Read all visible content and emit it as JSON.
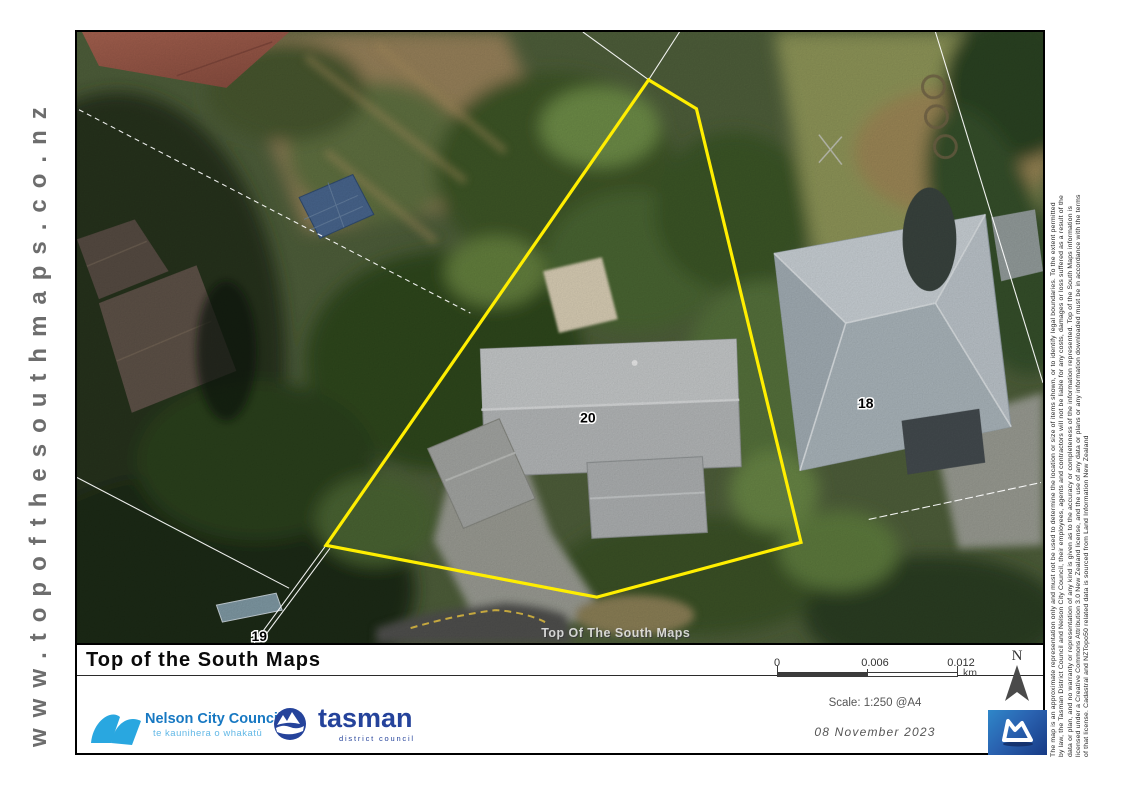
{
  "branding": {
    "website_vertical_text": "www.topofthesouthmaps.co.nz"
  },
  "map": {
    "watermark": "Top Of The South Maps",
    "boundary_color": "#ffee00",
    "parcel_labels": [
      {
        "text": "20"
      },
      {
        "text": "18"
      },
      {
        "text": "19"
      }
    ]
  },
  "footer": {
    "title": "Top of the South Maps",
    "nelson_logo": {
      "name": "Nelson City Council",
      "maori_name": "te kaunihera o whakatū",
      "brand_color": "#29a7e0"
    },
    "tasman_logo": {
      "name": "tasman",
      "subtitle": "district council",
      "brand_color": "#25439b"
    },
    "scale_bar": {
      "ticks": [
        "0",
        "0.006",
        "0.012"
      ],
      "unit": "km"
    },
    "scale_text": "Scale: 1:250 @A4",
    "date": "08 November 2023",
    "north": {
      "label": "N"
    }
  },
  "disclaimer": {
    "lines": [
      "The map is an approximate representation only and must not be used to determine the location or size of items shown, or to identify legal boundaries. To the extent permitted",
      "by law, the Tasman District Council and Nelson City Council, their employees, agents and contractors will not be liable for any costs, damages or loss suffered as a result of the",
      "data or plan, and no warranty or representation of any kind is given as to the accuracy or completeness of the information represented. Top of the South Maps information is",
      "licensed under a Creative Commons Attribution 3.0 New Zealand license, and the use of any data or plans or any information downloaded must be in accordance with the terms",
      "of that license. Cadastral and NZTopo50 related data is sourced from Land Information New Zealand"
    ]
  }
}
